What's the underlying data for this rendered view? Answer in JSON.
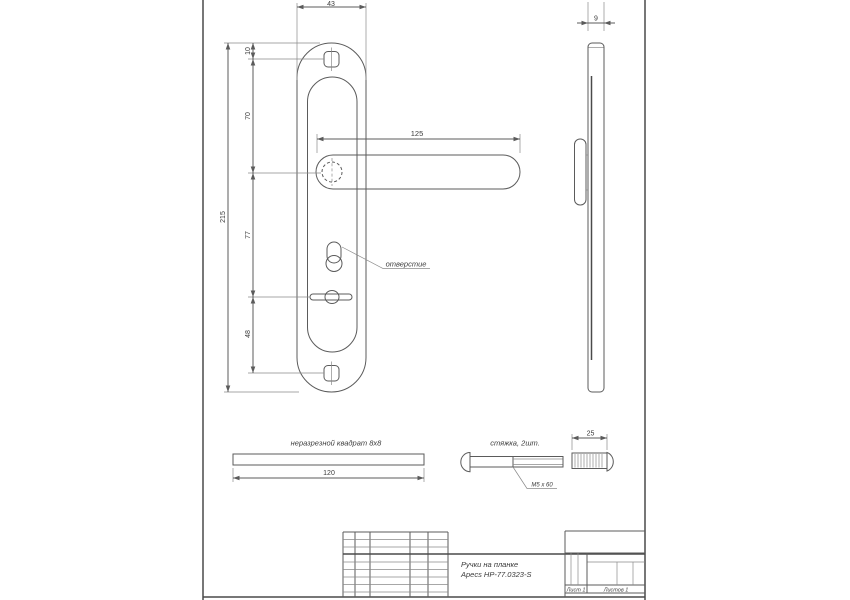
{
  "page": {
    "background": "#ffffff",
    "line_color": "#5b5b5b",
    "text_color": "#3b3b3b"
  },
  "front_view": {
    "dim_plate_width": "43",
    "dim_top_to_screw": "10",
    "dim_screw_to_handle": "70",
    "dim_total_height": "215",
    "dim_handle_to_spindle": "77",
    "dim_spindle_to_screw": "48",
    "dim_handle_length": "125",
    "keyhole_callout": "отверстие"
  },
  "side_view": {
    "dim_thickness": "9"
  },
  "detail_square_bar": {
    "label": "неразрезной квадрат 8х8",
    "dim_length": "120"
  },
  "detail_tie_screw": {
    "label": "стяжка, 2шт.",
    "thread_note": "М5 х 60",
    "dim_sleeve_length": "25"
  },
  "title_block": {
    "doc_name_line1": "Ручки на планке",
    "doc_name_line2": "Apecs HP-77.0323-S",
    "sheet_label": "Лист 1",
    "sheets_label": "Листов 1"
  }
}
